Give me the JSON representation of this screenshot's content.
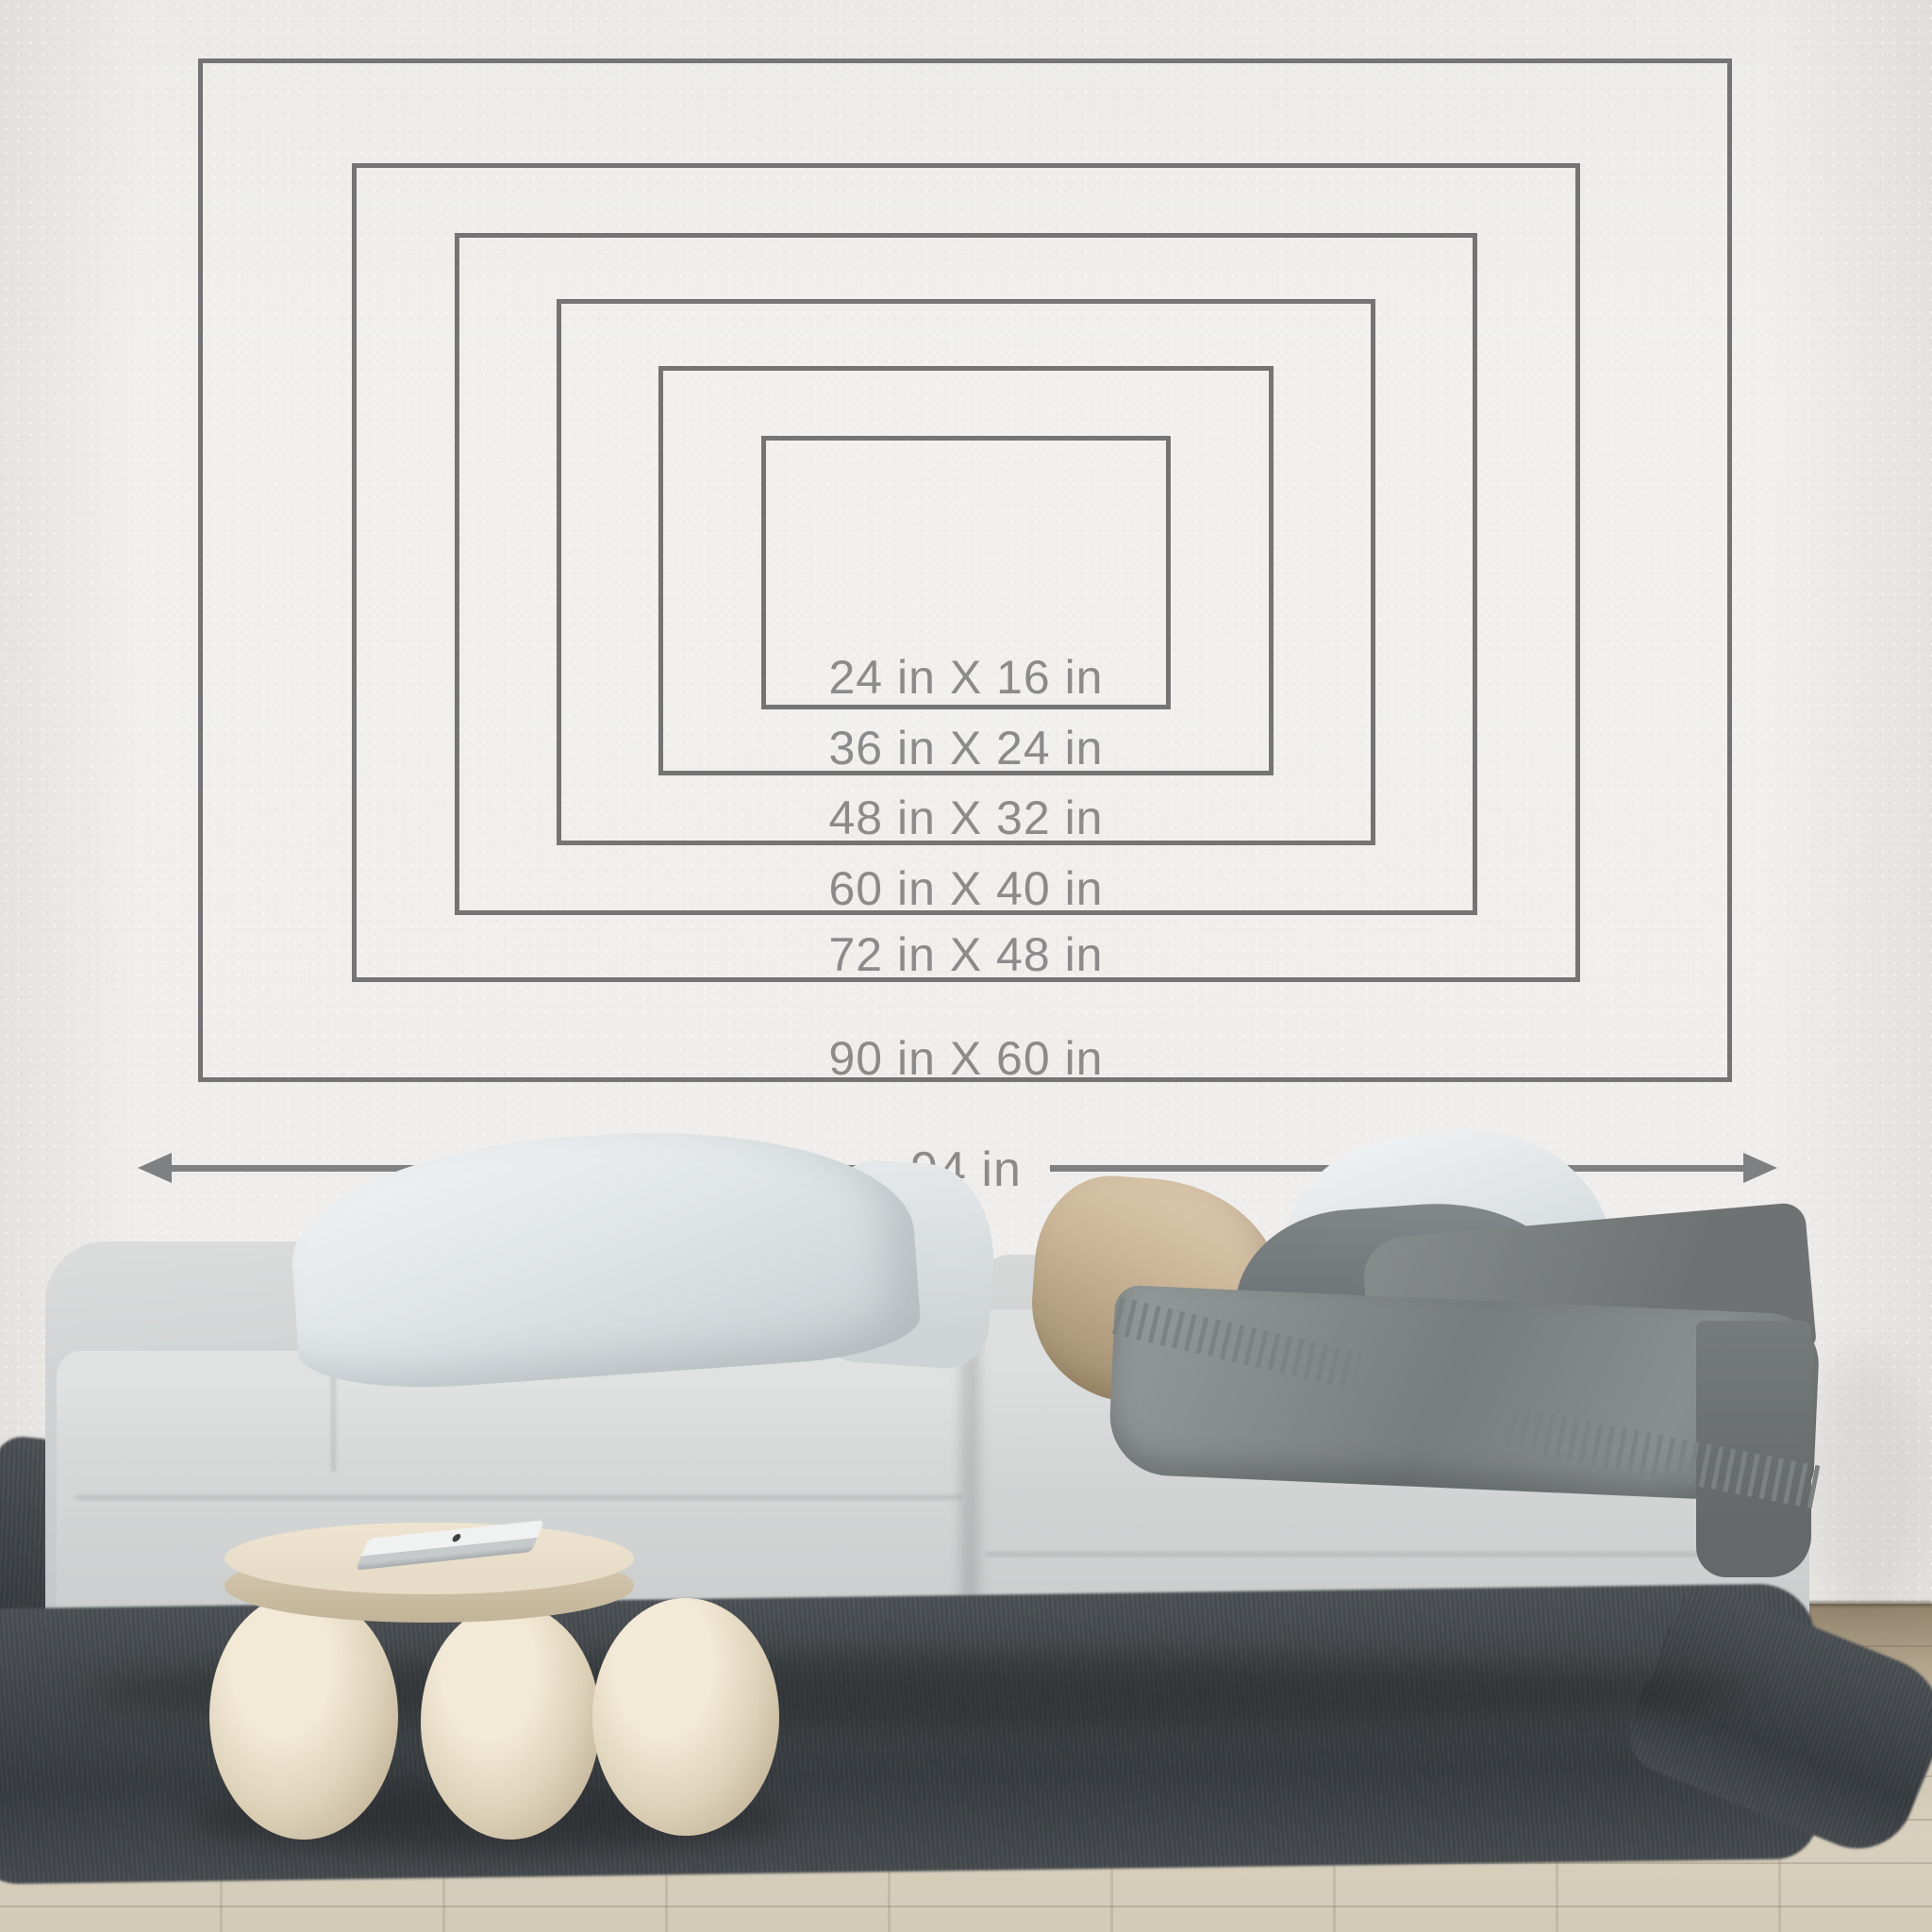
{
  "size_chart": {
    "sizes": [
      {
        "label": "24 in X 16 in",
        "width_in": 24,
        "height_in": 16
      },
      {
        "label": "36 in X 24 in",
        "width_in": 36,
        "height_in": 24
      },
      {
        "label": "48 in X 32 in",
        "width_in": 48,
        "height_in": 32
      },
      {
        "label": "60 in X 40 in",
        "width_in": 60,
        "height_in": 40
      },
      {
        "label": "72 in X 48 in",
        "width_in": 72,
        "height_in": 48
      },
      {
        "label": "90 in X 60 in",
        "width_in": 90,
        "height_in": 60
      }
    ],
    "wall_width_label": "94 in",
    "wall_width_in": 94
  },
  "palette": {
    "line": "#747474",
    "label-text": "#8b8b8b",
    "arrow": "#7e8082",
    "wall": "#f1f0ee",
    "sofa": "#d2d5d5",
    "rug": "#4d5256",
    "floor": "#d6ccba",
    "table": "#e6dcc8",
    "pillow-beige": "#c9b494",
    "pillow-dark": "#6d7276",
    "blanket": "#828787"
  }
}
